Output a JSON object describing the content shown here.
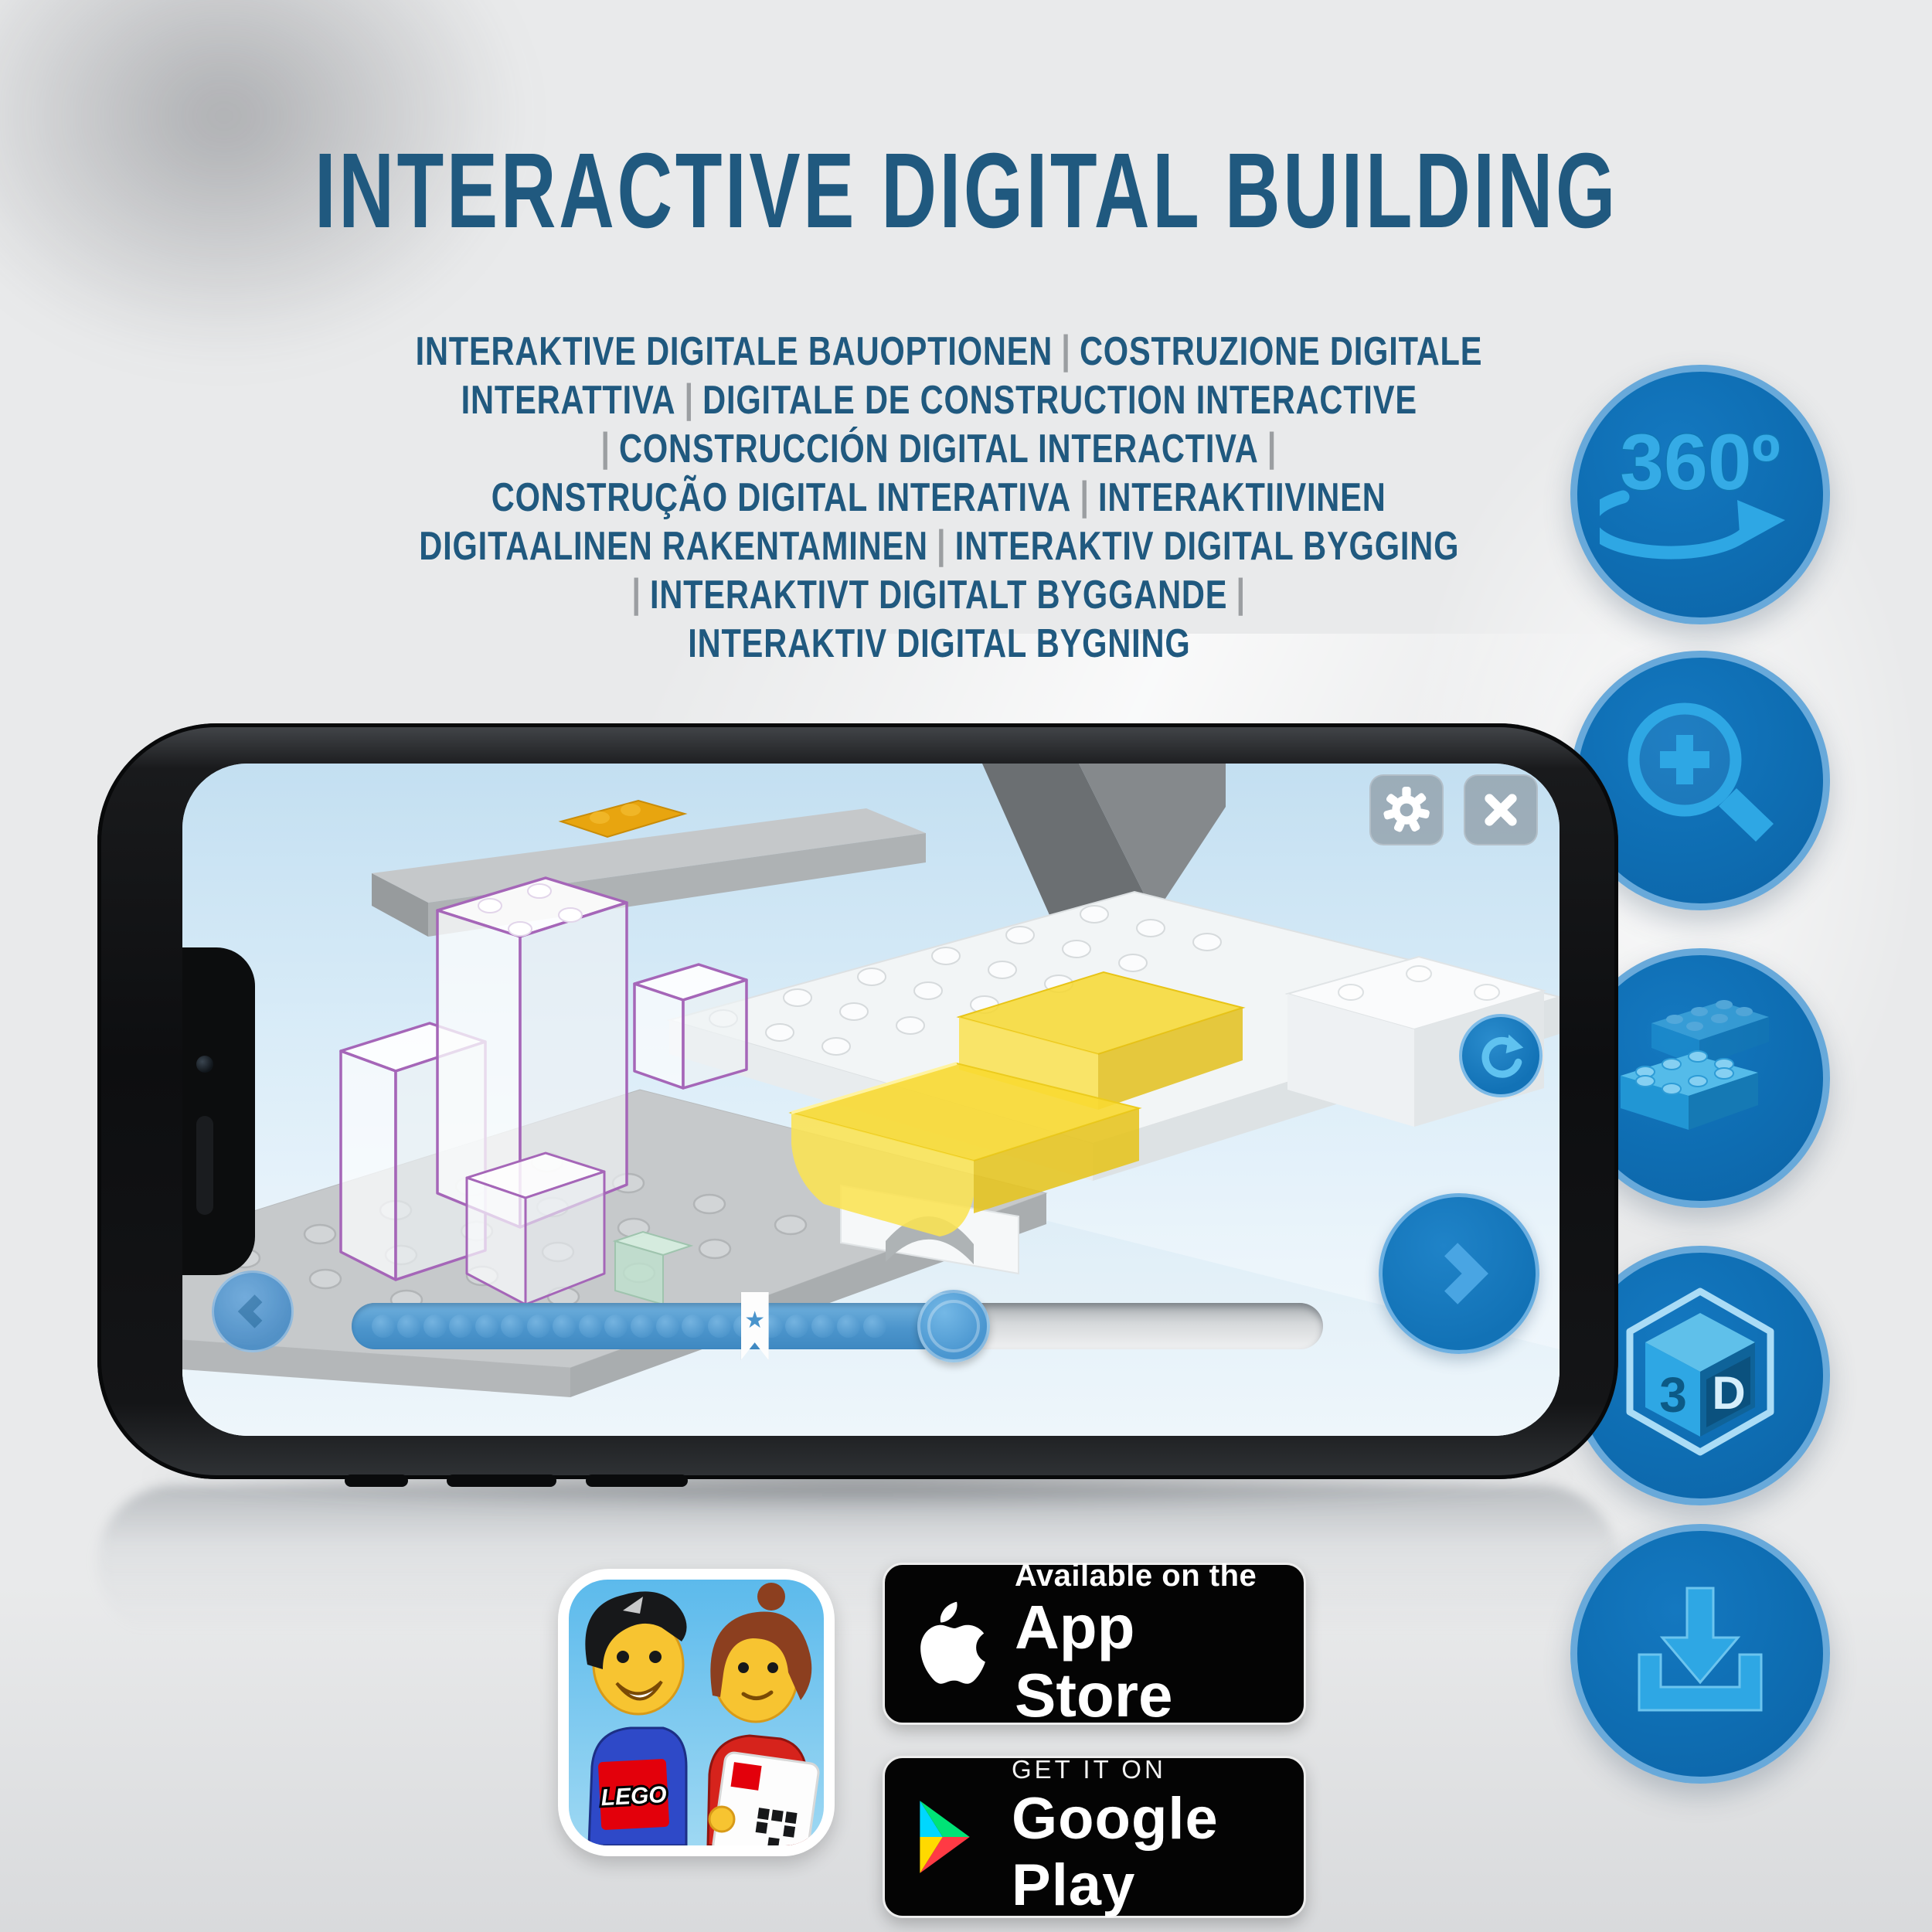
{
  "header": {
    "title": "INTERACTIVE DIGITAL BUILDING"
  },
  "subtitle": {
    "lines": [
      "INTERAKTIVE DIGITALE BAUOPTIONEN | COSTRUZIONE DIGITALE",
      "INTERATTIVA | DIGITALE DE CONSTRUCTION INTERACTIVE",
      "| CONSTRUCCIÓN DIGITAL INTERACTIVA |",
      "CONSTRUÇÃO DIGITAL INTERATIVA | INTERAKTIIVINEN",
      "DIGITAALINEN RAKENTAMINEN | INTERAKTIV DIGITAL BYGGING",
      "| INTERAKTIVT DIGITALT BYGGANDE |",
      "INTERAKTIV DIGITAL BYGNING"
    ]
  },
  "feature_icons": [
    {
      "name": "360-rotation-icon",
      "label": "360º"
    },
    {
      "name": "zoom-in-icon"
    },
    {
      "name": "lego-brick-icon"
    },
    {
      "name": "3d-cube-icon",
      "face_left": "3",
      "face_right": "D"
    },
    {
      "name": "download-icon"
    }
  ],
  "phone": {
    "screen_controls": {
      "settings_icon": "gear",
      "close_icon": "x",
      "rotate_icon": "rotate-arrow",
      "previous_icon": "chevron-left",
      "next_icon": "chevron-right",
      "progress": {
        "dots": 20,
        "filled_ratio": 0.625,
        "bookmark_ratio": 0.415,
        "thumb_ratio": 0.62,
        "bookmark_symbol": "★"
      }
    }
  },
  "store_badges": {
    "app_store": {
      "top_line": "Available on the",
      "bottom_line": "App Store"
    },
    "google_play": {
      "top_line": "GET IT ON",
      "bottom_line": "Google Play"
    }
  },
  "app_icon": {
    "logo_text": "LEGO"
  },
  "colors": {
    "heading_blue": "#20597f",
    "separator_gray": "#9b9ea1",
    "circle_fill": "#0e6db2",
    "circle_border": "#68a9da",
    "icon_blue": "#2ea7e4",
    "icon_blue_light": "#8fd6f4",
    "icon_blue_dark": "#0f77b4",
    "lego_yellow": "#f2d22e",
    "selection_purple": "#a566b8",
    "progress_blue": "#4c95cc",
    "lego_red": "#e3000b",
    "play_teal": "#00d7fe",
    "play_green": "#00e376",
    "play_yellow": "#ffd900",
    "play_red": "#ff3a44"
  }
}
